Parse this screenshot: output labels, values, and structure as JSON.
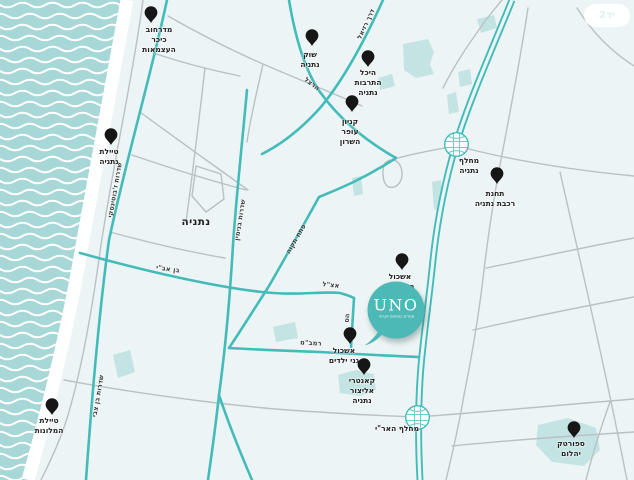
{
  "city_label": "נתניה",
  "watermark": "יד2",
  "uno_marker": {
    "name": "UNO",
    "tagline": "מגורים במתחם יוקרתי"
  },
  "colors": {
    "sea": "#a7d7d6",
    "wave": "#ffffff",
    "land": "#edf4f5",
    "beach": "#ffffff",
    "road_teal": "#43bcb9",
    "road_gray": "#b9c1c4",
    "patch": "#c3e4e3",
    "pin": "#161616",
    "uno_bubble": "#4db9b6",
    "label_text": "#222222"
  },
  "pois": [
    {
      "id": "midrahov-kikar-haatzmaut",
      "label": [
        "מדרחוב",
        "כיכר",
        "העצמאות"
      ],
      "x": 151,
      "y": 15,
      "marker": "pin",
      "dx": 8,
      "dy": 10
    },
    {
      "id": "shuk-netanya",
      "label": [
        "שוק",
        "נתניה"
      ],
      "x": 312,
      "y": 38,
      "marker": "pin",
      "dx": -2,
      "dy": 12
    },
    {
      "id": "heichal-hatarbut-netanya",
      "label": [
        "היכל",
        "התרבות",
        "נתניה"
      ],
      "x": 368,
      "y": 59,
      "marker": "pin",
      "dx": 0,
      "dy": 9
    },
    {
      "id": "kanyon-ofer-hasharon",
      "label": [
        "קניון",
        "עופר",
        "השרון"
      ],
      "x": 352,
      "y": 104,
      "marker": "pin",
      "dx": -2,
      "dy": 13
    },
    {
      "id": "tayelet-netanya",
      "label": [
        "טיילת",
        "נתניה"
      ],
      "x": 111,
      "y": 137,
      "marker": "pin",
      "dx": -2,
      "dy": 10
    },
    {
      "id": "mechlef-netanya",
      "label": [
        "מחלף",
        "נתניה"
      ],
      "x": 456,
      "y": 144,
      "marker": "interchange",
      "dx": 13,
      "dy": 12
    },
    {
      "id": "tachanat-rakevet-netanya",
      "label": [
        "תחנת",
        "רכבת נתניה"
      ],
      "x": 497,
      "y": 176,
      "marker": "pin",
      "dx": -2,
      "dy": 13
    },
    {
      "id": "eshkol-batei-sefer",
      "label": [
        "אשכול",
        "בתי ספר"
      ],
      "x": 402,
      "y": 262,
      "marker": "pin",
      "dx": -2,
      "dy": 10
    },
    {
      "id": "eshkol-ganei-yeladim",
      "label": [
        "אשכול",
        "גני ילדים"
      ],
      "x": 350,
      "y": 336,
      "marker": "pin",
      "dx": -6,
      "dy": 10
    },
    {
      "id": "kantri-elitzur-netanya",
      "label": [
        "קאנטרי",
        "אליצור",
        "נתניה"
      ],
      "x": 364,
      "y": 367,
      "marker": "pin",
      "dx": -2,
      "dy": 9
    },
    {
      "id": "tayelet-hamalonot",
      "label": [
        "טיילת",
        "המלונות"
      ],
      "x": 52,
      "y": 407,
      "marker": "pin",
      "dx": -3,
      "dy": 9
    },
    {
      "id": "mechlef-haari",
      "label": [
        "מחלף האר\"י"
      ],
      "x": 417,
      "y": 417,
      "marker": "interchange",
      "dx": -20,
      "dy": 7
    },
    {
      "id": "sportek-yahalom",
      "label": [
        "ספורטק",
        "יהלום"
      ],
      "x": 574,
      "y": 430,
      "marker": "pin",
      "dx": -3,
      "dy": 9
    }
  ],
  "road_labels": [
    {
      "text": "דרך רזיאל",
      "x": 366,
      "y": 24,
      "rot": -65
    },
    {
      "text": "הרצל",
      "x": 312,
      "y": 84,
      "rot": 38
    },
    {
      "text": "שדרות ז'בוטינסקי",
      "x": 115,
      "y": 190,
      "rot": -80
    },
    {
      "text": "שדרות בנימין",
      "x": 240,
      "y": 220,
      "rot": -81
    },
    {
      "text": "פתח תקוה",
      "x": 296,
      "y": 239,
      "rot": -60
    },
    {
      "text": "בן אב\"י",
      "x": 168,
      "y": 269,
      "rot": 8
    },
    {
      "text": "אצ\"ל",
      "x": 331,
      "y": 285,
      "rot": 6
    },
    {
      "text": "הס",
      "x": 347,
      "y": 318,
      "rot": -85
    },
    {
      "text": "רמב\"ם",
      "x": 311,
      "y": 343,
      "rot": 3
    },
    {
      "text": "שדרות בן צבי",
      "x": 98,
      "y": 396,
      "rot": -80
    }
  ]
}
